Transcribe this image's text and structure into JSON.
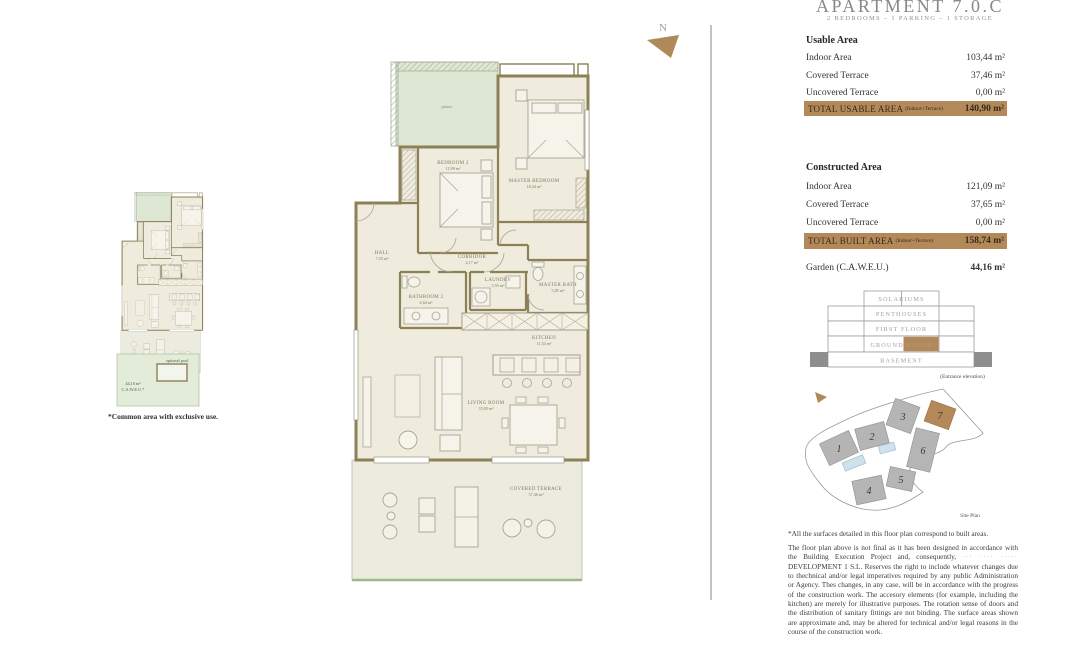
{
  "header": {
    "title": "APARTMENT 7.0.C",
    "subtitle": "2 BEDROOMS – 1 PARKING – 1 STORAGE"
  },
  "usable_area": {
    "heading": "Usable Area",
    "rows": [
      {
        "label": "Indoor Area",
        "value": "103,44 m²"
      },
      {
        "label": "Covered Terrace",
        "value": "37,46 m²"
      },
      {
        "label": "Uncovered Terrace",
        "value": "0,00 m²"
      }
    ],
    "total": {
      "label": "TOTAL USABLE AREA",
      "qualifier": "(Indoor+Terrace)",
      "value": "140,90 m²"
    }
  },
  "constructed_area": {
    "heading": "Constructed Area",
    "rows": [
      {
        "label": "Indoor Area",
        "value": "121,09 m²"
      },
      {
        "label": "Covered Terrace",
        "value": "37,65 m²"
      },
      {
        "label": "Uncovered Terrace",
        "value": "0,00 m²"
      }
    ],
    "total": {
      "label": "TOTAL BUILT AREA",
      "qualifier": "(Indoor+Terrace)",
      "value": "158,74 m²"
    },
    "garden": {
      "label": "Garden (C.A.W.E.U.)",
      "value": "44,16 m²"
    }
  },
  "elevation": {
    "levels": [
      "SOLARIUMS",
      "PENTHOUSES",
      "FIRST FLOOR",
      "GROUND FLOOR",
      "BASEMENT"
    ],
    "highlighted_level": "GROUND FLOOR",
    "caption": "(Entrance elevation)"
  },
  "site_plan": {
    "buildings": [
      "1",
      "2",
      "3",
      "4",
      "5",
      "6",
      "7"
    ],
    "highlighted_building": "7",
    "caption": "Site Plan"
  },
  "floor_plan": {
    "rooms": {
      "plants": {
        "name": "plants"
      },
      "bedroom2": {
        "name": "BEDROOM 2",
        "area": "11,99 m²"
      },
      "master_bedroom": {
        "name": "MASTER BEDROOM",
        "area": "18,44 m²"
      },
      "hall": {
        "name": "HALL",
        "area": "7,53 m²"
      },
      "corridor": {
        "name": "CORRIDOR",
        "area": "4,17 m²"
      },
      "bathroom2": {
        "name": "BATHROOM 2",
        "area": "4,64 m²"
      },
      "laundry": {
        "name": "LAUNDRY",
        "area": "3,55 m²"
      },
      "master_bath": {
        "name": "MASTER BATH",
        "area": "5,85 m²"
      },
      "kitchen": {
        "name": "KITCHEN",
        "area": "11,54 m²"
      },
      "living_room": {
        "name": "LIVING ROOM",
        "area": "35,95 m²"
      },
      "covered_terrace": {
        "name": "COVERED TERRACE",
        "area": "37,46 m²"
      }
    }
  },
  "mini_plan": {
    "pool_label": "optional pool",
    "garden_area": "44,16 m²",
    "garden_note": "C.A.W.E.U.*",
    "caption": "*Common area with exclusive use."
  },
  "north": {
    "label": "N"
  },
  "disclaimer": {
    "note": "*All the surfaces detailed in this floor plan correspond to built areas.",
    "body_start": "The floor plan above is not final as it has been designed in accordance with the Building Execution Project and, consequently, ",
    "redacted": "··· ···· ·····",
    "body_end": " DEVELOPMENT 1 S.L. Reserves the right to include whatever changes due to thechnical and/or legal imperatives required by any public Administration or Agency. Thes changes, in any case, will be in accordance with the progress of the construction work. The accesory elements (for example, including the kitchen) are merely for illustrative purposes. The rotation sense of doors and the distribution of sanitary fittings are not binding. The surface areas shown are approximate and, may be altered for technical and/or legal reasons in the course of the construction work."
  },
  "colors": {
    "accent": "#b4895a",
    "wall": "#8d8056",
    "plan_floor": "#efecdd",
    "plants_green": "#dde7d4",
    "pool_blue": "#cfe2ec"
  }
}
